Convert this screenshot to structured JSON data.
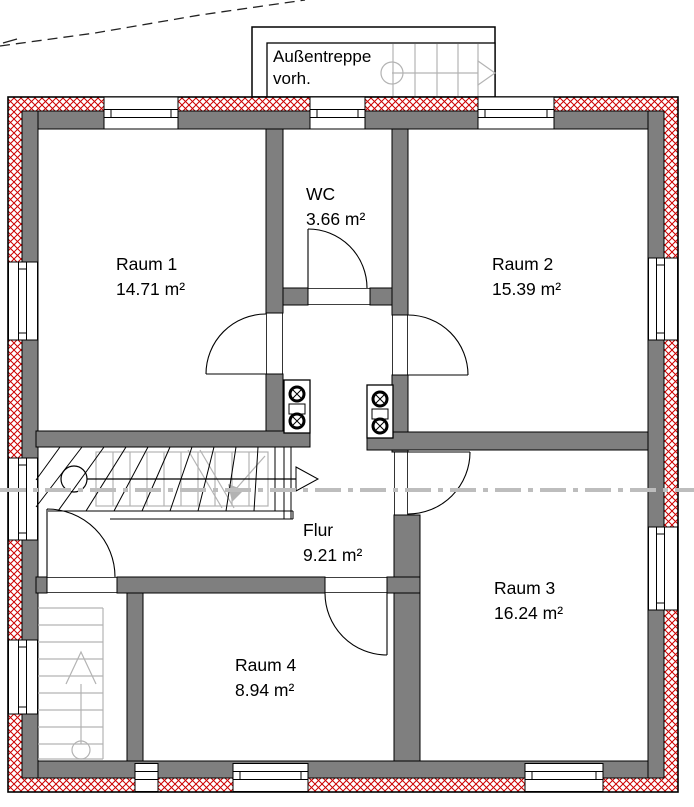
{
  "drawing": {
    "type": "floor-plan",
    "note": {
      "line1": "Außentreppe",
      "line2": "vorh."
    }
  },
  "rooms": [
    {
      "id": "raum1",
      "label": "Raum 1",
      "area": "14.71 m²"
    },
    {
      "id": "wc",
      "label": "WC",
      "area": "3.66 m²"
    },
    {
      "id": "raum2",
      "label": "Raum 2",
      "area": "15.39 m²"
    },
    {
      "id": "raum3",
      "label": "Raum 3",
      "area": "16.24 m²"
    },
    {
      "id": "raum4",
      "label": "Raum 4",
      "area": "8.94 m²"
    },
    {
      "id": "flur",
      "label": "Flur",
      "area": "9.21 m²"
    }
  ],
  "colors": {
    "wall_gray": "#7f7f7f",
    "insulation_red": "#cc0000",
    "overlay_gray": "#b3b3b3",
    "section_line_gray": "#bdbdbd"
  }
}
